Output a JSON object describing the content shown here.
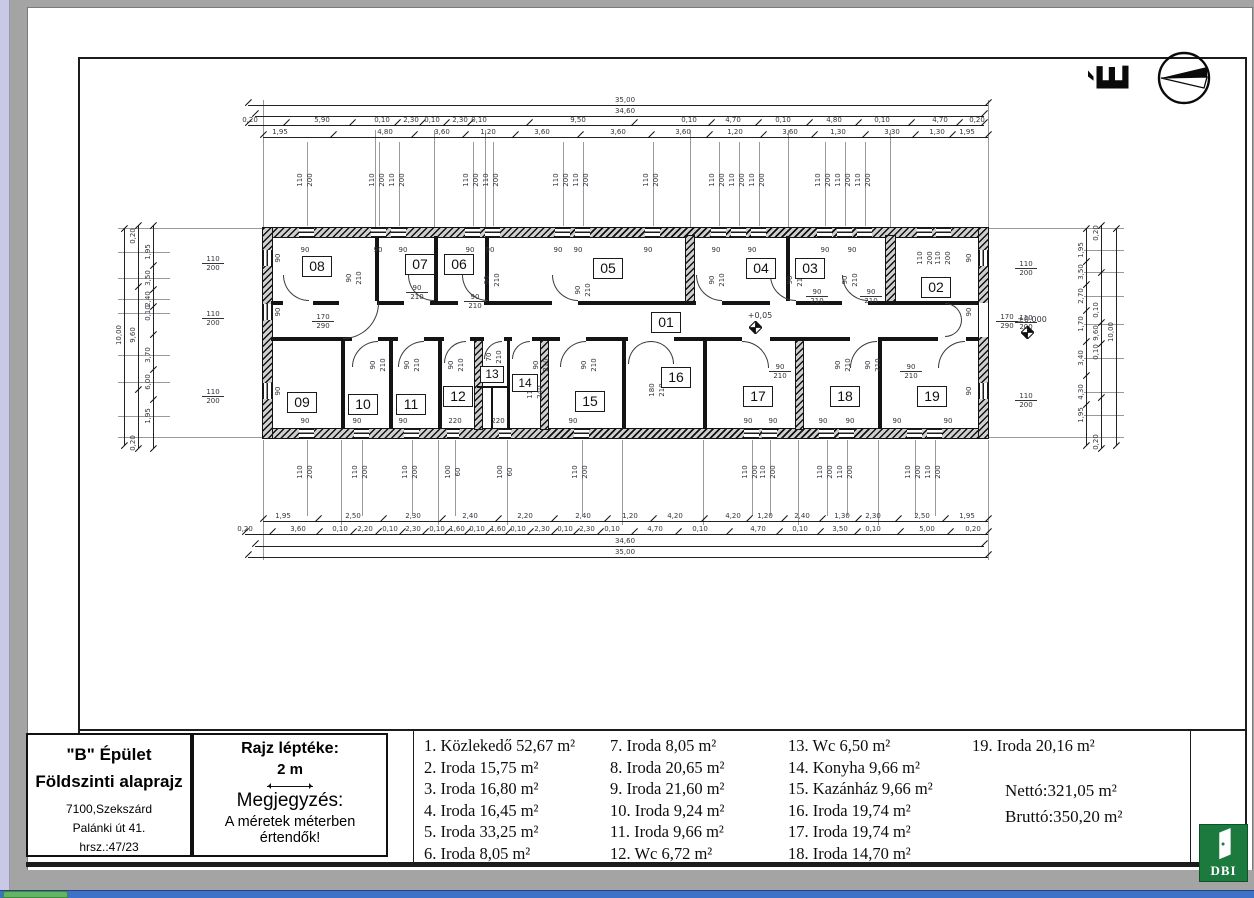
{
  "north_symbol": {
    "letter": "É"
  },
  "title_block": {
    "building": "\"B\" Épület",
    "floor": "Földszinti alaprajz",
    "city": "7100,Szekszárd",
    "street": "Palánki út 41.",
    "parcel": "hrsz.:47/23"
  },
  "scale_block": {
    "heading": "Rajz léptéke:",
    "value": "2 m",
    "note_heading": "Megjegyzés:",
    "note_line1": "A méretek méterben",
    "note_line2": "értendők!"
  },
  "legend": {
    "columns": [
      [
        "1. Közlekedő 52,67 m²",
        "2. Iroda 15,75 m²",
        "3. Iroda 16,80 m²",
        "4. Iroda 16,45 m²",
        "5. Iroda 33,25 m²",
        "6. Iroda 8,05 m²"
      ],
      [
        "7.  Iroda 8,05 m²",
        "8.  Iroda 20,65 m²",
        "9.  Iroda 21,60 m²",
        "10. Iroda 9,24 m²",
        "11. Iroda 9,66 m²",
        "12. Wc 6,72 m²"
      ],
      [
        "13. Wc 6,50 m²",
        "14. Konyha 9,66 m²",
        "15. Kazánház 9,66 m²",
        "16. Iroda 19,74 m²",
        "17. Iroda 19,74 m²",
        "18. Iroda 14,70 m²"
      ],
      [
        "19. Iroda 20,16 m²"
      ]
    ],
    "totals": [
      "Nettó:321,05 m²",
      "Bruttó:350,20 m²"
    ]
  },
  "logo": {
    "text": "DBI"
  },
  "colors": {
    "logo_green": "#1d7a3f",
    "taskbar_blue": "#3e72c8",
    "taskbar_green": "#63b563",
    "scrollbar": "#c9c9e6"
  },
  "plan": {
    "rooms": [
      {
        "id": "01",
        "x": 666,
        "y": 322
      },
      {
        "id": "02",
        "x": 936,
        "y": 287
      },
      {
        "id": "03",
        "x": 810,
        "y": 268
      },
      {
        "id": "04",
        "x": 761,
        "y": 268
      },
      {
        "id": "05",
        "x": 608,
        "y": 268
      },
      {
        "id": "06",
        "x": 459,
        "y": 264
      },
      {
        "id": "07",
        "x": 420,
        "y": 264
      },
      {
        "id": "08",
        "x": 317,
        "y": 266
      },
      {
        "id": "09",
        "x": 302,
        "y": 402
      },
      {
        "id": "10",
        "x": 363,
        "y": 404
      },
      {
        "id": "11",
        "x": 411,
        "y": 404
      },
      {
        "id": "12",
        "x": 458,
        "y": 396
      },
      {
        "id": "13",
        "x": 492,
        "y": 374,
        "w": 24,
        "h": 17
      },
      {
        "id": "14",
        "x": 525,
        "y": 383,
        "w": 26,
        "h": 18
      },
      {
        "id": "15",
        "x": 590,
        "y": 401
      },
      {
        "id": "16",
        "x": 676,
        "y": 377
      },
      {
        "id": "17",
        "x": 758,
        "y": 396
      },
      {
        "id": "18",
        "x": 845,
        "y": 396
      },
      {
        "id": "19",
        "x": 932,
        "y": 396
      }
    ],
    "h_dim_rows": [
      {
        "y": 96,
        "x1": 248,
        "x2": 988,
        "labels": [
          {
            "t": "35,00",
            "x": 625
          }
        ]
      },
      {
        "y": 107,
        "x1": 255,
        "x2": 984,
        "labels": [
          {
            "t": "34,60",
            "x": 625
          }
        ]
      },
      {
        "y": 116,
        "x1": 248,
        "x2": 984,
        "labels": [
          {
            "t": "0,20",
            "x": 250
          },
          {
            "t": "5,90",
            "x": 322
          },
          {
            "t": "0,10",
            "x": 382
          },
          {
            "t": "2,30",
            "x": 411
          },
          {
            "t": "0,10",
            "x": 432
          },
          {
            "t": "2,30",
            "x": 460
          },
          {
            "t": "0,10",
            "x": 479
          },
          {
            "t": "9,50",
            "x": 578
          },
          {
            "t": "0,10",
            "x": 689
          },
          {
            "t": "4,70",
            "x": 733
          },
          {
            "t": "0,10",
            "x": 783
          },
          {
            "t": "4,80",
            "x": 834
          },
          {
            "t": "0,10",
            "x": 882
          },
          {
            "t": "4,70",
            "x": 940
          },
          {
            "t": "0,20",
            "x": 977
          }
        ]
      },
      {
        "y": 128,
        "x1": 263,
        "x2": 988,
        "labels": [
          {
            "t": "1,95",
            "x": 280
          },
          {
            "t": "4,80",
            "x": 385
          },
          {
            "t": "3,60",
            "x": 442
          },
          {
            "t": "1,20",
            "x": 488
          },
          {
            "t": "3,60",
            "x": 542
          },
          {
            "t": "3,60",
            "x": 618
          },
          {
            "t": "3,60",
            "x": 683
          },
          {
            "t": "1,20",
            "x": 735
          },
          {
            "t": "3,60",
            "x": 790
          },
          {
            "t": "1,30",
            "x": 838
          },
          {
            "t": "3,30",
            "x": 892
          },
          {
            "t": "1,30",
            "x": 937
          },
          {
            "t": "1,95",
            "x": 967
          }
        ]
      },
      {
        "y": 512,
        "x1": 263,
        "x2": 988,
        "labels": [
          {
            "t": "1,95",
            "x": 283
          },
          {
            "t": "2,50",
            "x": 353
          },
          {
            "t": "2,30",
            "x": 413
          },
          {
            "t": "2,40",
            "x": 470
          },
          {
            "t": "2,20",
            "x": 525
          },
          {
            "t": "2,40",
            "x": 583
          },
          {
            "t": "1,20",
            "x": 630
          },
          {
            "t": "4,20",
            "x": 675
          },
          {
            "t": "4,20",
            "x": 733
          },
          {
            "t": "1,20",
            "x": 765
          },
          {
            "t": "2,40",
            "x": 802
          },
          {
            "t": "1,30",
            "x": 842
          },
          {
            "t": "2,30",
            "x": 873
          },
          {
            "t": "2,50",
            "x": 922
          },
          {
            "t": "1,95",
            "x": 967
          }
        ]
      },
      {
        "y": 525,
        "x1": 245,
        "x2": 988,
        "labels": [
          {
            "t": "0,20",
            "x": 245
          },
          {
            "t": "3,60",
            "x": 298
          },
          {
            "t": "0,10",
            "x": 340
          },
          {
            "t": "2,20",
            "x": 365
          },
          {
            "t": "0,10",
            "x": 390
          },
          {
            "t": "2,30",
            "x": 413
          },
          {
            "t": "0,10",
            "x": 437
          },
          {
            "t": "1,60",
            "x": 457
          },
          {
            "t": "0,10",
            "x": 477
          },
          {
            "t": "1,60",
            "x": 498
          },
          {
            "t": "0,10",
            "x": 518
          },
          {
            "t": "2,30",
            "x": 542
          },
          {
            "t": "0,10",
            "x": 565
          },
          {
            "t": "2,30",
            "x": 587
          },
          {
            "t": "0,10",
            "x": 612
          },
          {
            "t": "4,70",
            "x": 655
          },
          {
            "t": "0,10",
            "x": 700
          },
          {
            "t": "4,70",
            "x": 758
          },
          {
            "t": "0,10",
            "x": 800
          },
          {
            "t": "3,50",
            "x": 840
          },
          {
            "t": "0,10",
            "x": 873
          },
          {
            "t": "5,00",
            "x": 927
          },
          {
            "t": "0,20",
            "x": 973
          }
        ]
      },
      {
        "y": 537,
        "x1": 255,
        "x2": 984,
        "labels": [
          {
            "t": "34,60",
            "x": 625
          }
        ]
      },
      {
        "y": 548,
        "x1": 248,
        "x2": 988,
        "labels": [
          {
            "t": "35,00",
            "x": 625
          }
        ]
      }
    ],
    "v_dim_cols": [
      {
        "x": 124,
        "y1": 228,
        "y2": 445,
        "labels": [
          {
            "t": "10,00",
            "y": 335
          }
        ]
      },
      {
        "x": 138,
        "y1": 225,
        "y2": 448,
        "labels": [
          {
            "t": "0,20",
            "y": 236
          },
          {
            "t": "9,60",
            "y": 335
          },
          {
            "t": "0,20",
            "y": 443
          }
        ]
      },
      {
        "x": 153,
        "y1": 225,
        "y2": 448,
        "labels": [
          {
            "t": "1,95",
            "y": 252
          },
          {
            "t": "3,50",
            "y": 278
          },
          {
            "t": "2,40",
            "y": 299
          },
          {
            "t": "0,10",
            "y": 313
          },
          {
            "t": "3,70",
            "y": 355
          },
          {
            "t": "6,00",
            "y": 382
          },
          {
            "t": "1,95",
            "y": 416
          }
        ]
      },
      {
        "x": 1086,
        "y1": 228,
        "y2": 445,
        "labels": [
          {
            "t": "1,95",
            "y": 250
          },
          {
            "t": "3,50",
            "y": 272
          },
          {
            "t": "2,70",
            "y": 296
          },
          {
            "t": "1,70",
            "y": 324
          },
          {
            "t": "3,40",
            "y": 358
          },
          {
            "t": "4,30",
            "y": 392
          },
          {
            "t": "1,95",
            "y": 415
          }
        ]
      },
      {
        "x": 1101,
        "y1": 225,
        "y2": 448,
        "labels": [
          {
            "t": "0,20",
            "y": 233
          },
          {
            "t": "0,10",
            "y": 310
          },
          {
            "t": "9,60",
            "y": 333
          },
          {
            "t": "0,10",
            "y": 352
          },
          {
            "t": "0,20",
            "y": 442
          }
        ]
      },
      {
        "x": 1116,
        "y1": 228,
        "y2": 445,
        "labels": [
          {
            "t": "10,00",
            "y": 332
          }
        ]
      }
    ],
    "window_pairs_top": [
      {
        "x": 300
      },
      {
        "x": 372
      },
      {
        "x": 392
      },
      {
        "x": 466
      },
      {
        "x": 486
      },
      {
        "x": 556
      },
      {
        "x": 576
      },
      {
        "x": 646
      },
      {
        "x": 712
      },
      {
        "x": 732
      },
      {
        "x": 752
      },
      {
        "x": 818
      },
      {
        "x": 838
      },
      {
        "x": 858
      },
      {
        "x": 920,
        "y": 258
      },
      {
        "x": 938,
        "y": 258
      }
    ],
    "window_pairs_bottom": [
      {
        "x": 300
      },
      {
        "x": 355
      },
      {
        "x": 405
      },
      {
        "x": 448,
        "a": "100",
        "b": "60"
      },
      {
        "x": 500,
        "a": "100",
        "b": "60"
      },
      {
        "x": 575
      },
      {
        "x": 745
      },
      {
        "x": 763
      },
      {
        "x": 820
      },
      {
        "x": 840
      },
      {
        "x": 908
      },
      {
        "x": 928
      }
    ],
    "side_fracs": [
      {
        "x": 213,
        "y": 255
      },
      {
        "x": 213,
        "y": 310
      },
      {
        "x": 213,
        "y": 388
      },
      {
        "x": 1026,
        "y": 260
      },
      {
        "x": 1026,
        "y": 314
      },
      {
        "x": 1026,
        "y": 392
      }
    ],
    "door_fracs": [
      {
        "x": 323,
        "y": 313,
        "a": "170",
        "b": "290"
      },
      {
        "x": 1007,
        "y": 313,
        "a": "170",
        "b": "290"
      },
      {
        "x": 417,
        "y": 284,
        "a": "90",
        "b": "210"
      },
      {
        "x": 475,
        "y": 293,
        "a": "90",
        "b": "210"
      },
      {
        "x": 817,
        "y": 288,
        "a": "90",
        "b": "210"
      },
      {
        "x": 871,
        "y": 288,
        "a": "90",
        "b": "210"
      },
      {
        "x": 780,
        "y": 363,
        "a": "90",
        "b": "210"
      },
      {
        "x": 911,
        "y": 363,
        "a": "90",
        "b": "210"
      }
    ],
    "rot_pairs": [
      {
        "x": 349,
        "y": 278
      },
      {
        "x": 487,
        "y": 280
      },
      {
        "x": 578,
        "y": 290
      },
      {
        "x": 712,
        "y": 280
      },
      {
        "x": 790,
        "y": 280
      },
      {
        "x": 845,
        "y": 280
      },
      {
        "x": 373,
        "y": 365
      },
      {
        "x": 407,
        "y": 365
      },
      {
        "x": 451,
        "y": 365
      },
      {
        "x": 536,
        "y": 365
      },
      {
        "x": 584,
        "y": 365
      },
      {
        "x": 838,
        "y": 365
      },
      {
        "x": 868,
        "y": 365
      },
      {
        "x": 652,
        "y": 390,
        "a": "180",
        "b": "210"
      },
      {
        "x": 530,
        "y": 392,
        "a": "110",
        "b": "240"
      },
      {
        "x": 489,
        "y": 357,
        "a": "70",
        "b": "210"
      }
    ],
    "rot_singles": [
      {
        "t": "90",
        "x": 278,
        "y": 258
      },
      {
        "t": "90",
        "x": 278,
        "y": 312
      },
      {
        "t": "90",
        "x": 278,
        "y": 391
      },
      {
        "t": "90",
        "x": 969,
        "y": 258
      },
      {
        "t": "90",
        "x": 969,
        "y": 312
      },
      {
        "t": "90",
        "x": 969,
        "y": 391
      }
    ],
    "plain_labels": [
      {
        "t": "90",
        "x": 305,
        "y": 246
      },
      {
        "t": "90",
        "x": 378,
        "y": 246
      },
      {
        "t": "90",
        "x": 403,
        "y": 246
      },
      {
        "t": "90",
        "x": 470,
        "y": 246
      },
      {
        "t": "90",
        "x": 490,
        "y": 246
      },
      {
        "t": "90",
        "x": 558,
        "y": 246
      },
      {
        "t": "90",
        "x": 578,
        "y": 246
      },
      {
        "t": "90",
        "x": 648,
        "y": 246
      },
      {
        "t": "90",
        "x": 716,
        "y": 246
      },
      {
        "t": "90",
        "x": 752,
        "y": 246
      },
      {
        "t": "90",
        "x": 825,
        "y": 246
      },
      {
        "t": "90",
        "x": 852,
        "y": 246
      },
      {
        "t": "90",
        "x": 305,
        "y": 417
      },
      {
        "t": "90",
        "x": 357,
        "y": 417
      },
      {
        "t": "90",
        "x": 403,
        "y": 417
      },
      {
        "t": "90",
        "x": 573,
        "y": 417
      },
      {
        "t": "90",
        "x": 748,
        "y": 417
      },
      {
        "t": "90",
        "x": 773,
        "y": 417
      },
      {
        "t": "90",
        "x": 823,
        "y": 417
      },
      {
        "t": "90",
        "x": 850,
        "y": 417
      },
      {
        "t": "90",
        "x": 897,
        "y": 417
      },
      {
        "t": "90",
        "x": 948,
        "y": 417
      },
      {
        "t": "220",
        "x": 455,
        "y": 417
      },
      {
        "t": "220",
        "x": 498,
        "y": 417
      }
    ],
    "levels": [
      {
        "t": "+0,05",
        "x": 760,
        "y": 311,
        "sx": 749,
        "sy": 321
      },
      {
        "t": "±0,000",
        "x": 1032,
        "y": 315,
        "sx": 1021,
        "sy": 326
      }
    ]
  }
}
